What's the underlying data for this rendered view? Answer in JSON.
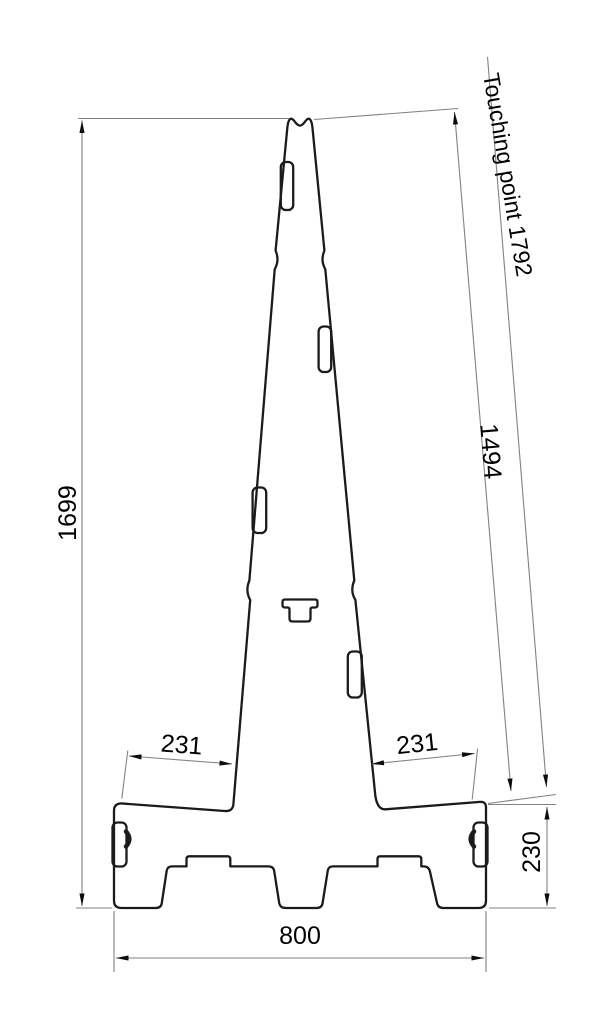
{
  "drawing": {
    "kind": "technical-dimension-drawing",
    "subject": "tapered pylon with base, side profile",
    "labels": {
      "overall_height": "1699",
      "slant_length": "1494",
      "touching_point": "Touching point 1792",
      "shoulder_left": "231",
      "shoulder_right": "231",
      "base_height": "230",
      "base_width": "800"
    },
    "colors": {
      "outline": "#1b1b1b",
      "dimension_line": "#828282",
      "arrow": "#0d0d0d",
      "text": "#000000",
      "background": "#ffffff"
    }
  }
}
